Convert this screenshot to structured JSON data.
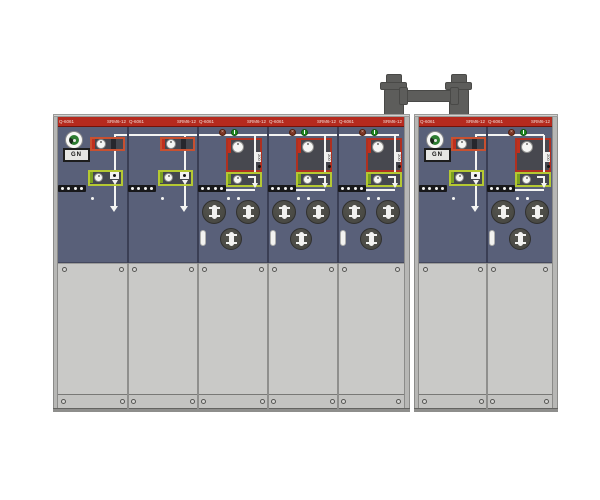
{
  "scene": {
    "description": "Front view of SF6 ring-main-unit switchgear: two cabinets linked by a top busbar bridge",
    "left_cabinet_panel_count": 5,
    "right_cabinet_panel_count": 2
  },
  "colors": {
    "band_red": "#b52a1e",
    "cabinet_blue": "#596079",
    "door_gray": "#c9c9c7",
    "side_gray": "#b7b7b5",
    "bridge_gray": "#5d5d5b",
    "switch_outline_orange": "#c85030",
    "fuse_outline_red": "#b03020",
    "earth_outline_green": "#b5c832",
    "mimic_white": "#f4f4f2"
  },
  "cabinets": [
    {
      "name": "left-cabinet",
      "x": 53,
      "w": 357,
      "bus": {
        "x1": 61,
        "x2": 346
      },
      "panels": [
        {
          "id": "panel-1",
          "x": 5,
          "w": 70,
          "type": "switch",
          "has_logo": true,
          "nameplate": "GN",
          "header_left": "Q-6061",
          "header_right": "SRM6-12"
        },
        {
          "id": "panel-2",
          "x": 75,
          "w": 70,
          "type": "switch",
          "header_left": "Q-6061",
          "header_right": "SRM6-12"
        },
        {
          "id": "panel-3",
          "x": 145,
          "w": 70,
          "type": "fuse",
          "fuse_rating": "200",
          "header_left": "Q-6061",
          "header_right": "SRM6-12"
        },
        {
          "id": "panel-4",
          "x": 215,
          "w": 70,
          "type": "fuse",
          "fuse_rating": "200",
          "header_left": "Q-6061",
          "header_right": "SRM6-12"
        },
        {
          "id": "panel-5",
          "x": 285,
          "w": 66,
          "type": "fuse",
          "fuse_rating": "200",
          "header_left": "Q-6061",
          "header_right": "SRM6-12"
        }
      ]
    },
    {
      "name": "right-cabinet",
      "x": 414,
      "w": 144,
      "bus": {
        "x1": 61,
        "x2": 130
      },
      "panels": [
        {
          "id": "panel-1",
          "x": 5,
          "w": 68,
          "type": "switch",
          "has_logo": true,
          "nameplate": "GN",
          "header_left": "Q-6061",
          "header_right": "SRM6-12"
        },
        {
          "id": "panel-2",
          "x": 73,
          "w": 65,
          "type": "fuse",
          "fuse_rating": "200",
          "header_left": "Q-6061",
          "header_right": "SRM6-12"
        }
      ]
    }
  ]
}
